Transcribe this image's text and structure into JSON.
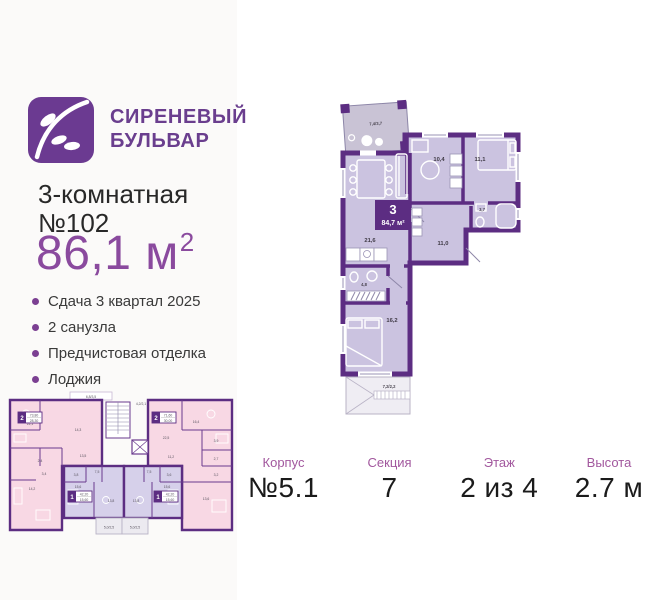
{
  "brand": {
    "name_line1": "СИРЕНЕВЫЙ",
    "name_line2": "БУЛЬВАР"
  },
  "listing": {
    "rooms_line": "3-комнатная",
    "number_line": "№102",
    "area": "86,1 м",
    "area_sup": "2",
    "features": [
      "Сдача 3 квартал 2025",
      "2 санузла",
      "Предчистовая отделка",
      "Лоджия"
    ]
  },
  "apartment_plan": {
    "badge": {
      "rooms": "3",
      "area": "84,7 м²"
    },
    "labels": {
      "loggia_top": "7,4/3,7",
      "kitchen": "10,4",
      "bedroom1": "11,1",
      "bath_small": "3,7",
      "hallway": "11,0",
      "living": "21,6",
      "bathroom": "4,8",
      "bedroom2": "16,2",
      "terrace": "7,2/2,2"
    }
  },
  "section_plan": {
    "balcony_top_left": "6,8/3,5",
    "balcony_top_right": "4,2/2,1",
    "apt_left": {
      "badge_rooms": "2",
      "badge_total": "73,80",
      "badge_living": "28,30",
      "rooms": {
        "r1": "22,1",
        "r2": "14,3",
        "r3": "13,5",
        "r4": "2,4",
        "r5": "3,4",
        "r6": "14,2"
      }
    },
    "apt_right": {
      "badge_rooms": "2",
      "badge_total": "71,60",
      "badge_living": "30,00",
      "rooms": {
        "r1": "16,4",
        "r2": "22,5",
        "r3": "3,9",
        "r4": "11,2",
        "r5": "2,7",
        "r6": "3,2",
        "r7": "13,6"
      }
    },
    "apt_bottom_left": {
      "badge_rooms": "1",
      "badge_total": "42,20",
      "badge_living": "15,60",
      "rooms": {
        "r1": "7,5",
        "r2": "3,8",
        "r3": "15,6",
        "r4": "13,8"
      },
      "loggia": "5,0/2,5"
    },
    "apt_bottom_right": {
      "badge_rooms": "1",
      "badge_total": "42,20",
      "badge_living": "15,60",
      "rooms": {
        "r1": "7,5",
        "r2": "3,6",
        "r3": "15,6",
        "r4": "13,8"
      },
      "loggia": "5,0/2,5"
    }
  },
  "details": {
    "items": [
      {
        "label": "Корпус",
        "value": "№5.1"
      },
      {
        "label": "Секция",
        "value": "7"
      },
      {
        "label": "Этаж",
        "value": "2 из 4"
      },
      {
        "label": "Высота",
        "value": "2.7 м"
      }
    ]
  },
  "colors": {
    "brand_purple": "#6b3a91",
    "wall_purple": "#5c2d82",
    "room_fill": "#cbc3e0",
    "pink_fill": "#f8d8e4",
    "lavender_fill": "#d6d0ea",
    "accent_label": "#a2589e",
    "area_purple": "#8a4a9e"
  }
}
